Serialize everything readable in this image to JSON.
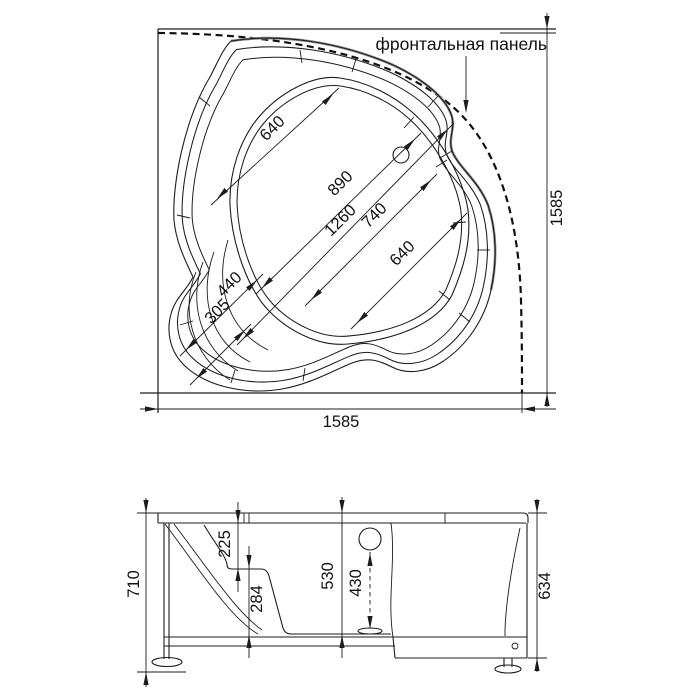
{
  "panel_label": "фронтальная панель",
  "plan": {
    "dim_overall_width": "1585",
    "dim_overall_height": "1585",
    "dim_bowl_upper_width": "640",
    "dim_bowl_mid_width": "890",
    "dim_inner_length": "1260",
    "dim_bowl_lower_width": "740",
    "dim_bowl_se_width": "640",
    "dim_seat_width": "440",
    "dim_seat_inner_width": "305"
  },
  "elevation": {
    "dim_total_height": "710",
    "dim_rim_to_seat": "225",
    "dim_seat_to_bottom": "284",
    "dim_inner_depth": "530",
    "dim_overflow_to_drain": "430",
    "dim_panel_height": "634"
  }
}
